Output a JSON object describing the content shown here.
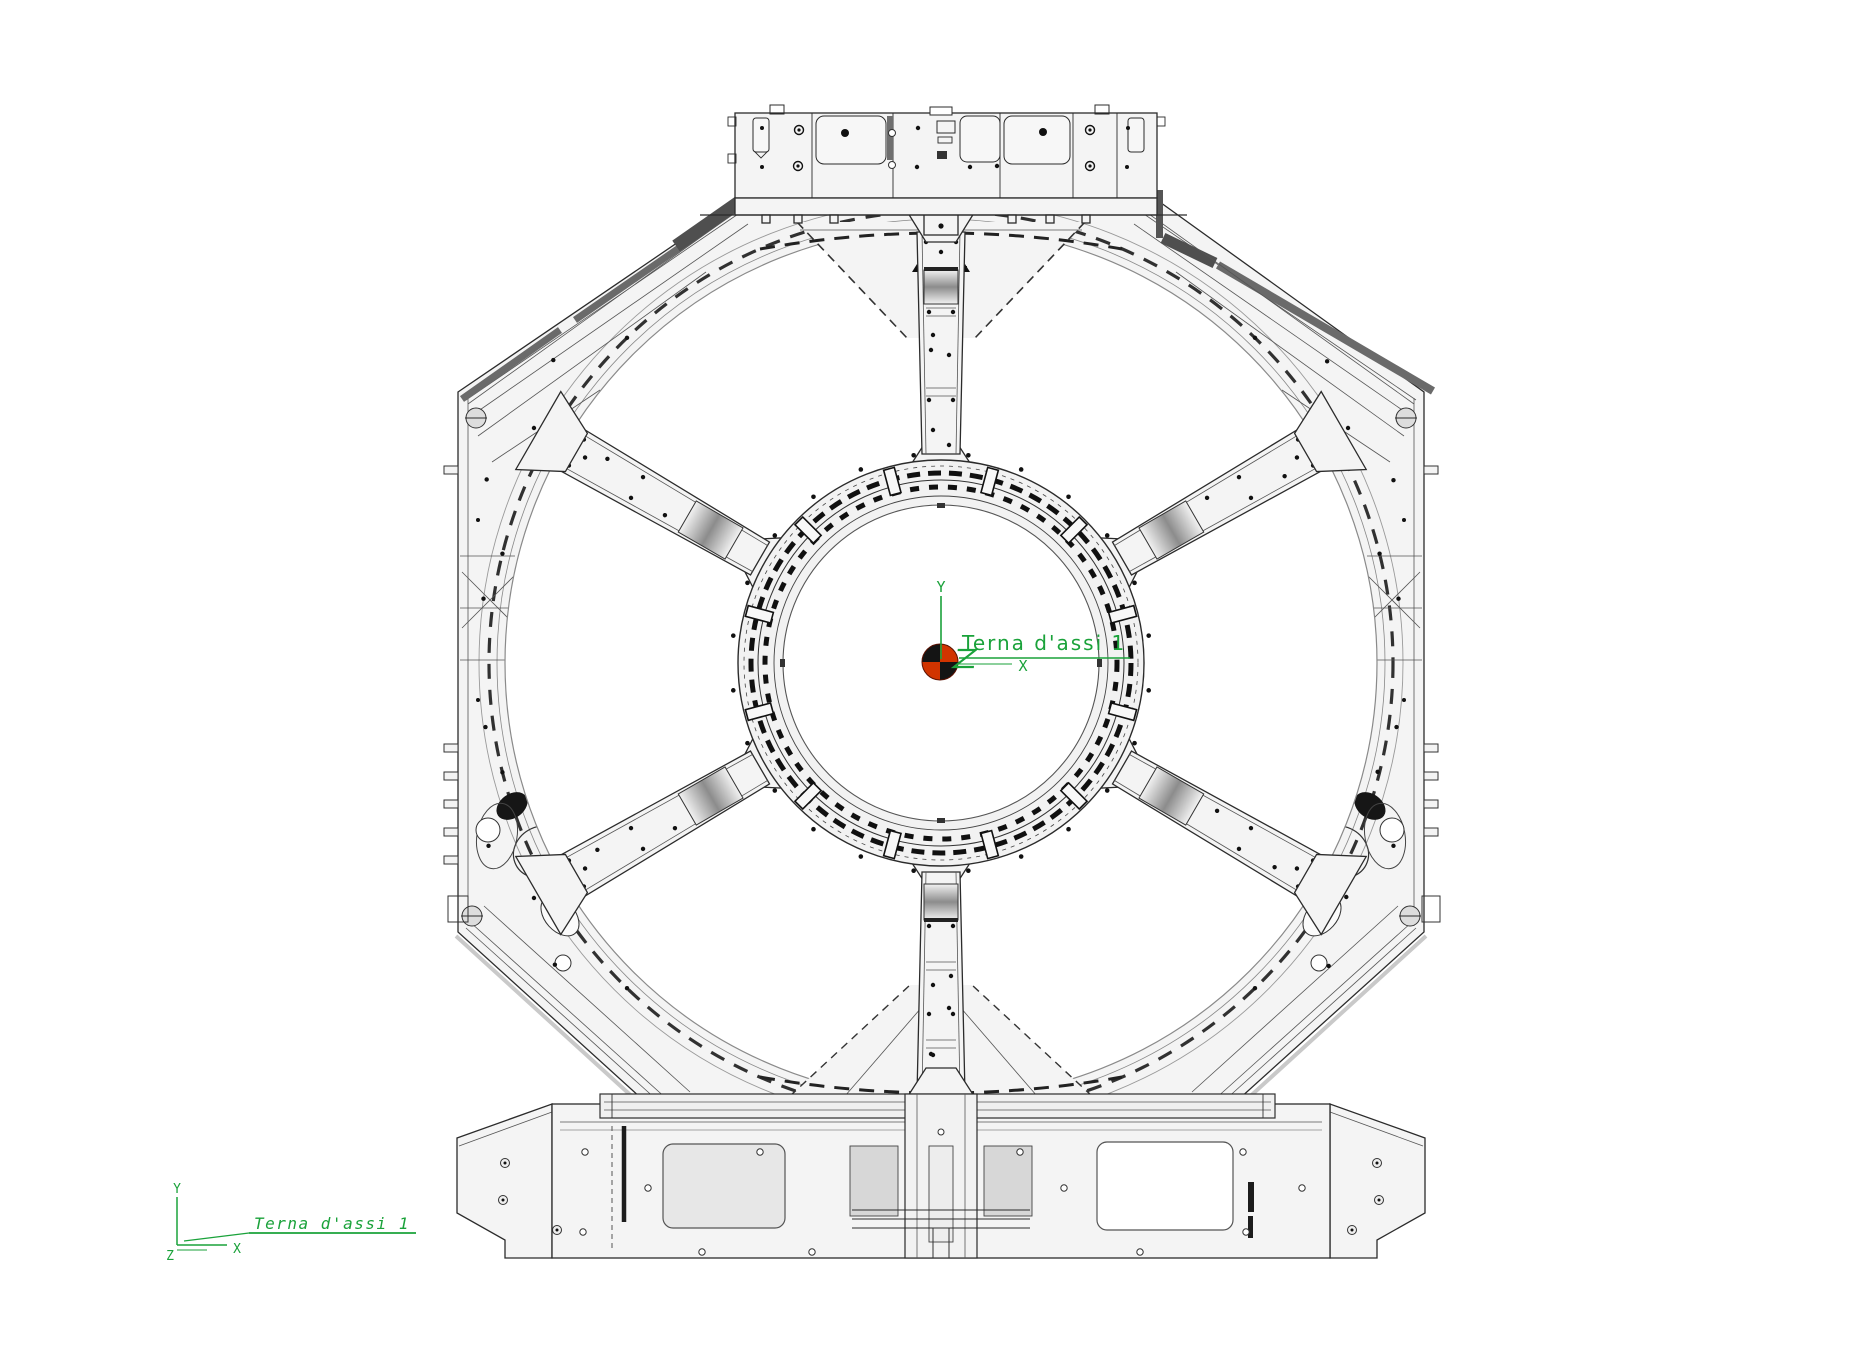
{
  "drawing": {
    "center_triad": {
      "label": "Terna d'assi 1",
      "axis_x": "X",
      "axis_y": "Y",
      "axis_z": "Z"
    },
    "origin_triad": {
      "label": "Terna d'assi 1",
      "axis_x": "X",
      "axis_y": "Y",
      "axis_z": "Z"
    },
    "colors": {
      "annotation_green": "#1aa23a",
      "marker_red": "#d13400",
      "marker_black": "#141414",
      "body_fill": "#f4f4f4",
      "outline": "#2b2b2b",
      "dark_strip": "#686868"
    }
  }
}
